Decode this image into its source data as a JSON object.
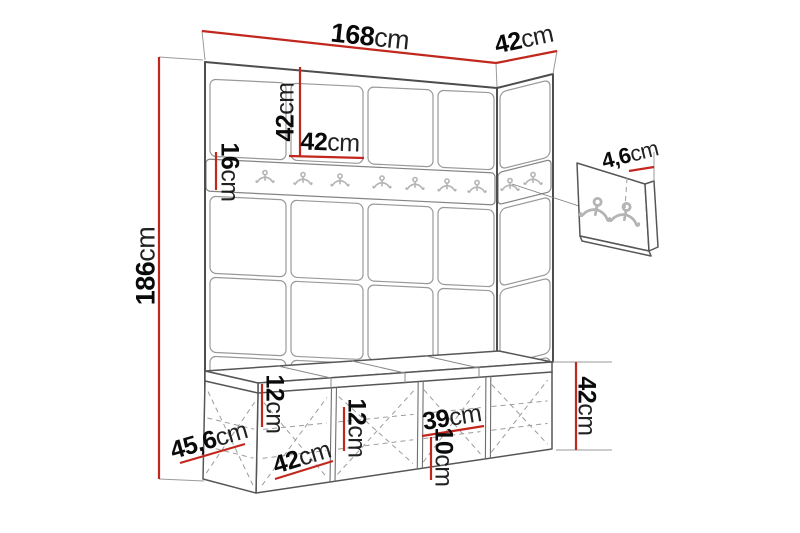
{
  "diagram": {
    "description": "Hallway wall panel set with hook rail, hook board and storage bench - dimension drawing",
    "accent_color": "#c2271d",
    "line_color": "#4d4d4d",
    "rail_hook_count": 9,
    "hook_board_hook_count": 2,
    "bench_section_count": 4
  },
  "dimensions": {
    "total_width": {
      "value": "168",
      "unit": "cm"
    },
    "side_depth": {
      "value": "42",
      "unit": "cm"
    },
    "panel_height": {
      "value": "42",
      "unit": "cm"
    },
    "panel_width": {
      "value": "42",
      "unit": "cm"
    },
    "rail_height": {
      "value": "16",
      "unit": "cm"
    },
    "total_height": {
      "value": "186",
      "unit": "cm"
    },
    "hook_board_depth": {
      "value": "4,6",
      "unit": "cm"
    },
    "bench_height": {
      "value": "42",
      "unit": "cm"
    },
    "shelf_spacing_left": {
      "value": "12",
      "unit": "cm"
    },
    "shelf_spacing_mid": {
      "value": "12",
      "unit": "cm"
    },
    "compartment_width": {
      "value": "39",
      "unit": "cm"
    },
    "shelf_spacing_right": {
      "value": "10",
      "unit": "cm"
    },
    "bench_depth": {
      "value": "45,6",
      "unit": "cm"
    },
    "bench_section_width": {
      "value": "42",
      "unit": "cm"
    }
  }
}
